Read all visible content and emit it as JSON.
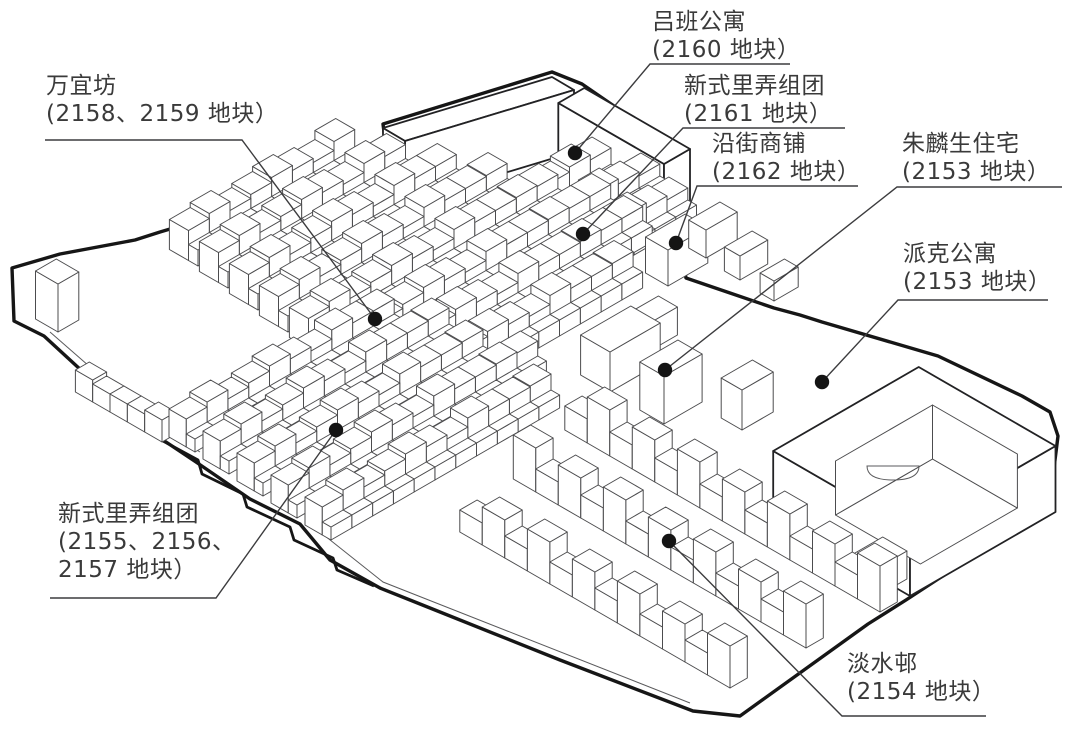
{
  "colors": {
    "background": "#ffffff",
    "line": "#4c4c4e",
    "bold_outline": "#161616",
    "leader": "#3c3c3e",
    "dot": "#141414",
    "label_text": "#3a3a3a"
  },
  "callouts": [
    {
      "id": "luban-apartment",
      "lines": [
        "吕班公寓",
        "(2160 地块）"
      ]
    },
    {
      "id": "new-lilong-2161",
      "lines": [
        "新式里弄组团",
        "(2161 地块）"
      ]
    },
    {
      "id": "street-shops-2162",
      "lines": [
        "沿街商铺",
        "(2162 地块）"
      ]
    },
    {
      "id": "zhulinsheng-house",
      "lines": [
        "朱麟生住宅",
        "(2153 地块）"
      ]
    },
    {
      "id": "parker-apartment",
      "lines": [
        "派克公寓",
        "(2153 地块）"
      ]
    },
    {
      "id": "wanyifang",
      "lines": [
        "万宜坊",
        "(2158、2159 地块）"
      ]
    },
    {
      "id": "new-lilong-2155-2157",
      "lines": [
        "新式里弄组团",
        "(2155、2156、",
        "2157 地块）"
      ]
    },
    {
      "id": "danshui-village",
      "lines": [
        "淡水邨",
        "(2154 地块）"
      ]
    }
  ]
}
